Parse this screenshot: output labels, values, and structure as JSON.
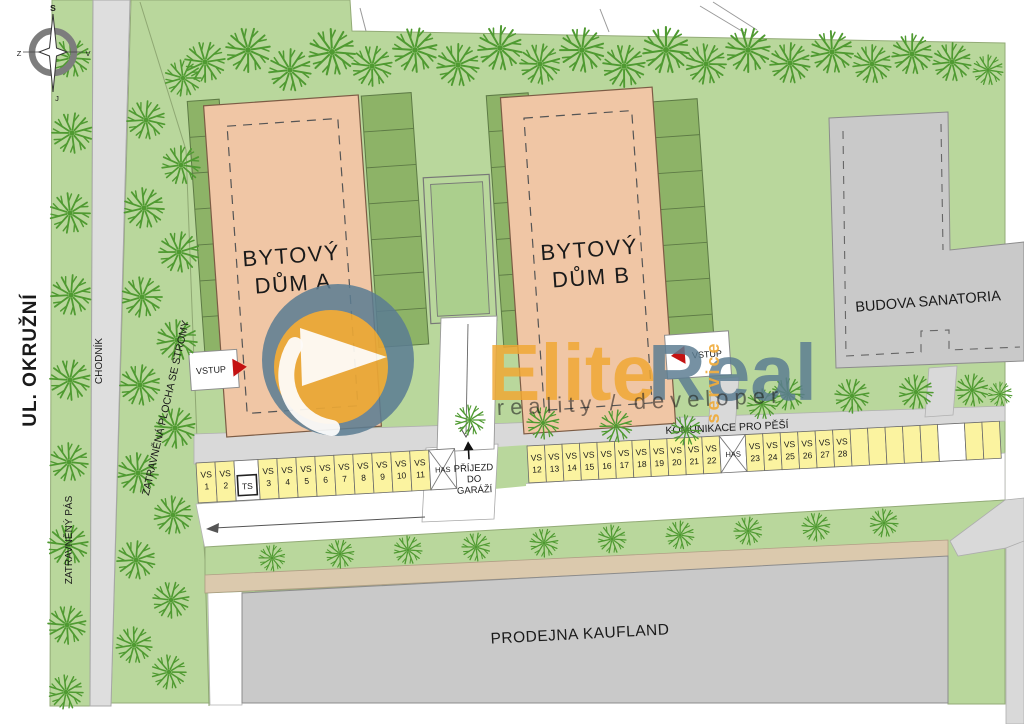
{
  "compass": {
    "north": "S",
    "south": "J",
    "west": "Z",
    "east": "V"
  },
  "streets": {
    "okruzni": "UL. OKRUŽNÍ",
    "chodnik": "CHODNÍK",
    "pas": "ZATRAVNĚNÝ PÁS",
    "plocha": "ZATRAVNĚNÁ PLOCHA SE STROMY"
  },
  "buildings": {
    "a": {
      "line1": "BYTOVÝ",
      "line2": "DŮM A",
      "entrance": "VSTUP"
    },
    "b": {
      "line1": "BYTOVÝ",
      "line2": "DŮM B",
      "entrance": "VSTUP"
    },
    "sanatoria": {
      "label": "BUDOVA SANATORIA"
    },
    "kaufland": {
      "label": "PRODEJNA KAUFLAND"
    }
  },
  "paths": {
    "pedestrian": "KOMUNIKACE PRO PĚŠÍ",
    "garage_line1": "PŘÍJEZD",
    "garage_line2": "DO",
    "garage_line3": "GARÁŽÍ"
  },
  "parking": {
    "vs_prefix": "VS",
    "ts_label": "TS",
    "has_label": "HAS",
    "row1": [
      {
        "type": "vs",
        "num": "1"
      },
      {
        "type": "vs",
        "num": "2"
      },
      {
        "type": "ts"
      },
      {
        "type": "vs",
        "num": "3"
      },
      {
        "type": "vs",
        "num": "4"
      },
      {
        "type": "vs",
        "num": "5"
      },
      {
        "type": "vs",
        "num": "6"
      },
      {
        "type": "vs",
        "num": "7"
      },
      {
        "type": "vs",
        "num": "8"
      },
      {
        "type": "vs",
        "num": "9"
      },
      {
        "type": "vs",
        "num": "10"
      },
      {
        "type": "vs",
        "num": "11"
      },
      {
        "type": "has"
      }
    ],
    "row2": [
      {
        "type": "vs",
        "num": "12"
      },
      {
        "type": "vs",
        "num": "13"
      },
      {
        "type": "vs",
        "num": "14"
      },
      {
        "type": "vs",
        "num": "15"
      },
      {
        "type": "vs",
        "num": "16"
      },
      {
        "type": "vs",
        "num": "17"
      },
      {
        "type": "vs",
        "num": "18"
      },
      {
        "type": "vs",
        "num": "19"
      },
      {
        "type": "vs",
        "num": "20"
      },
      {
        "type": "vs",
        "num": "21"
      },
      {
        "type": "vs",
        "num": "22"
      },
      {
        "type": "has"
      },
      {
        "type": "vs",
        "num": "23"
      },
      {
        "type": "vs",
        "num": "24"
      },
      {
        "type": "vs",
        "num": "25"
      },
      {
        "type": "vs",
        "num": "26"
      },
      {
        "type": "vs",
        "num": "27"
      },
      {
        "type": "vs",
        "num": "28"
      },
      {
        "type": "empty"
      },
      {
        "type": "empty"
      },
      {
        "type": "empty"
      },
      {
        "type": "empty"
      },
      {
        "type": "empty"
      },
      {
        "type": "gap"
      },
      {
        "type": "empty"
      },
      {
        "type": "empty"
      }
    ]
  },
  "logo": {
    "elite": "Elite",
    "real": "Real",
    "service": "service",
    "tagline": "reality / developer"
  },
  "colors": {
    "site_green": "#b9d79c",
    "stall_yellow": "#fbf3a0",
    "salmon": "#f0c6a5",
    "road_grey": "#d9d9d9",
    "bldg_grey": "#c9c9c9",
    "tan": "#dbc9ad",
    "garden": "#8db367",
    "tree_green": "#4f9a31",
    "red": "#c41212",
    "logo_orange": "#f0a833",
    "logo_blue": "#5b7d92"
  }
}
